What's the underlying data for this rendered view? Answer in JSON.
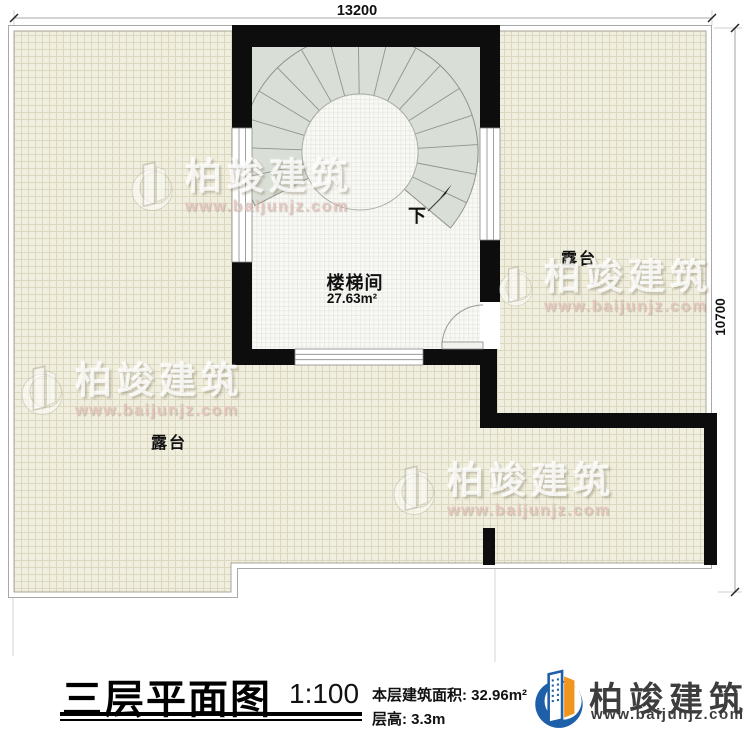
{
  "dimensions": {
    "top": "13200",
    "right": "10700"
  },
  "labels": {
    "stairwell": "楼梯间",
    "stairwell_area": "27.63m²",
    "terrace_right": "露台",
    "terrace_left": "露台",
    "stair_down": "下"
  },
  "titleblock": {
    "title": "三层平面图",
    "scale": "1:100",
    "area_line": "本层建筑面积: 32.96m²",
    "height_line": "层高: 3.3m"
  },
  "logo": {
    "name": "柏竣建筑",
    "site": "www.baijunjz.com"
  },
  "watermark": {
    "title": "柏竣建筑",
    "site": "www.baijunjz.com"
  },
  "colors": {
    "wall": "#0d0d0d",
    "terrace_tile": "#f0eede",
    "stair_fill": "#d9dfd6",
    "logo_blue": "#1d5fa8",
    "logo_orange": "#f0961e"
  }
}
